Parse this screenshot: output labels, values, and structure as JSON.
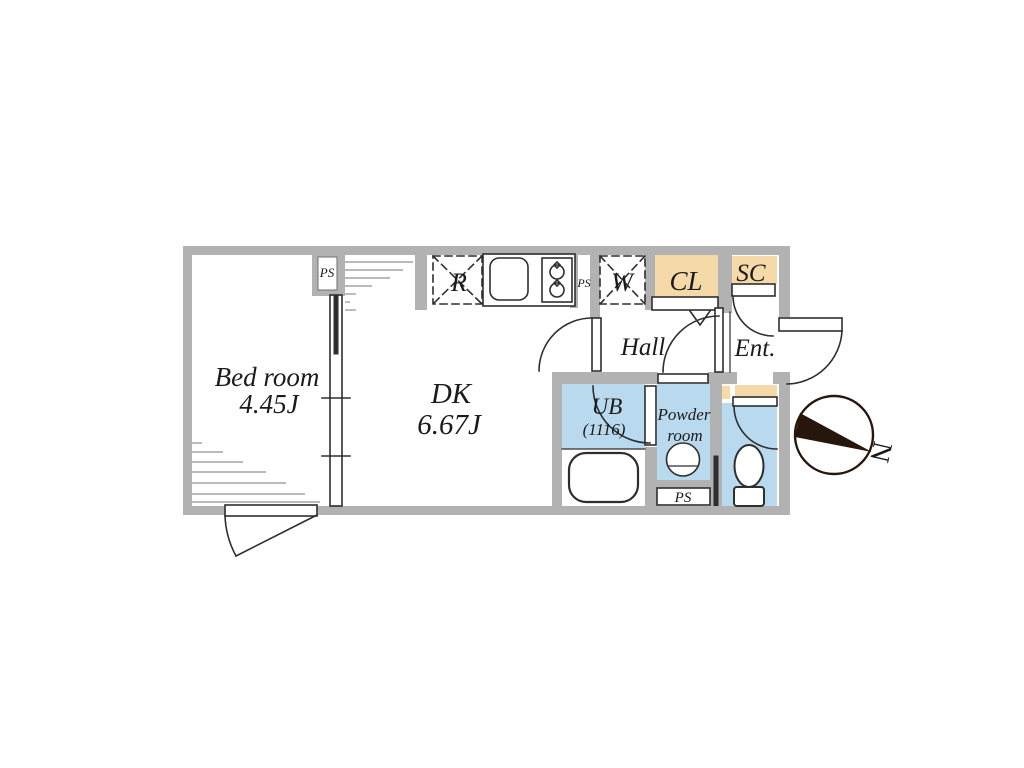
{
  "plan": {
    "bedroom_label": "Bed room",
    "bedroom_size": "4.45J",
    "dk_label": "DK",
    "dk_size": "6.67J",
    "hall_label": "Hall",
    "entrance_label": "Ent.",
    "closet_label": "CL",
    "shoe_closet_label": "SC",
    "refrigerator_label": "R",
    "washer_label": "W",
    "unit_bath_label": "UB",
    "unit_bath_size": "(1116)",
    "powder_room_line1": "Powder",
    "powder_room_line2": "room",
    "pipe_space_top": "PS",
    "pipe_space_kitchen": "PS",
    "pipe_space_bottom": "PS"
  },
  "compass": {
    "north_label": "N"
  },
  "colors": {
    "wall": "#b2b2b2",
    "closet_fill": "#f5d9a8",
    "wet_area_fill": "#b9daee",
    "fixture_fill": "#ffffff",
    "line": "#2e2e2e",
    "hatch_line": "#909090",
    "text": "#1b1b1b",
    "compass_dark": "#26160c"
  }
}
